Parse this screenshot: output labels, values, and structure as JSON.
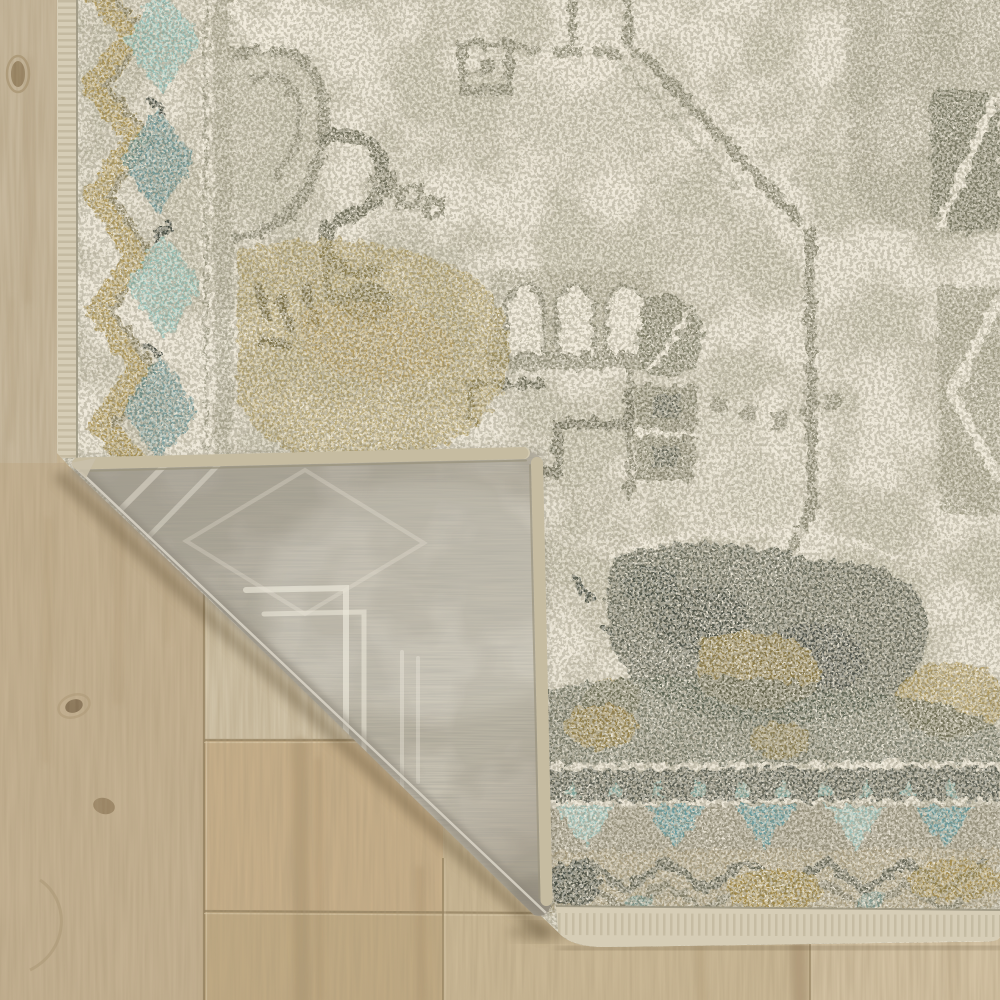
{
  "scene": {
    "type": "product-photo",
    "subject": "Distressed vintage-style medallion area rug with folded corner",
    "description": "Close-up of a distressed oriental medallion area rug in ivory, sage green, gold and teal. The bottom-left corner is folded over, revealing the woven grey rug backing with a faint ghost of the pattern, and exposing a light oak wood plank floor beneath.",
    "elements": [
      "distressed medallion field pattern in sage on ivory",
      "left border with gold zigzag and teal diamond motifs",
      "bottom border with teal triangle bands and dark zigzag",
      "folded corner showing woven grey backing and serged edges",
      "light oak laminate plank flooring with seams and knots"
    ]
  },
  "regions": {
    "wood_floor": "light oak plank floor, lower-left triangle and edge strips",
    "rug_front": "rug pile surface with distressed medallion pattern",
    "rug_left_border": "vertical border band with gold chevrons and teal diamonds",
    "rug_bottom_border": "horizontal border with teal triangles and zigzag bands",
    "folded_corner": "corner flap folded over showing grey woven backing",
    "rug_binding": "ivory serged edge binding along rug edges"
  },
  "palette": {
    "wood_base": "#cbb999",
    "wood_plank_left": "#c3b091",
    "wood_plank_pale": "#cfc2a7",
    "wood_plank_tan": "#c6ae89",
    "wood_plank_bottom": "#bfa983",
    "wood_plank_right": "#c9b795",
    "wood_seam": "#93805f",
    "rug_ivory": "#e9e3d3",
    "rug_sage": "#8a8772",
    "rug_sage_dark": "#6d6c58",
    "rug_dark_mass": "#5d6152",
    "rug_charcoal": "#454a40",
    "rug_gold": "#a18a46",
    "rug_teal": "#68999c",
    "rug_teal_light": "#9ec7c1",
    "rug_band_dark": "#50554b",
    "backing_base": "#b7b1a3",
    "backing_ghost": "#e7e2d4",
    "binding": "#d6cdb6"
  }
}
